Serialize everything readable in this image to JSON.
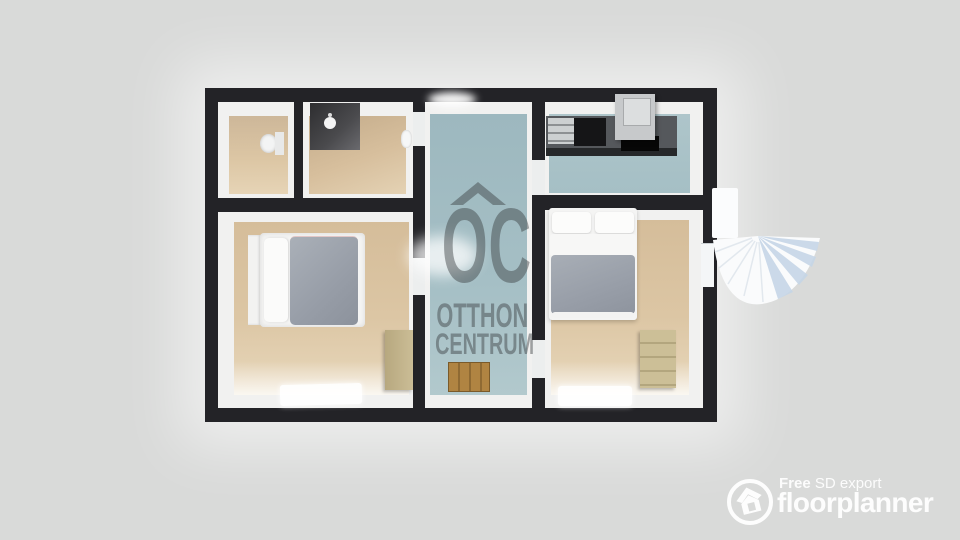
{
  "watermark": {
    "initials": "OC",
    "line1": "OTTHON",
    "line2": "CENTRUM"
  },
  "footer": {
    "free": "Free",
    "export": "SD export",
    "brand": "floorplanner"
  },
  "colors": {
    "background": "#d9dad9",
    "wall": "#232327",
    "wall_face": "#f1f1f0",
    "floor_wood": "#dcc6a4",
    "floor_tile": "#a5bfc5",
    "duvet": "#9aa1ab",
    "furniture_wood": "#cbbd96",
    "crate_wood": "#a87c42",
    "counter": "#55585c",
    "watermark_gray": "#6b7477",
    "stair_shade": "#c6d6e7",
    "logo_white": "#ffffff"
  }
}
